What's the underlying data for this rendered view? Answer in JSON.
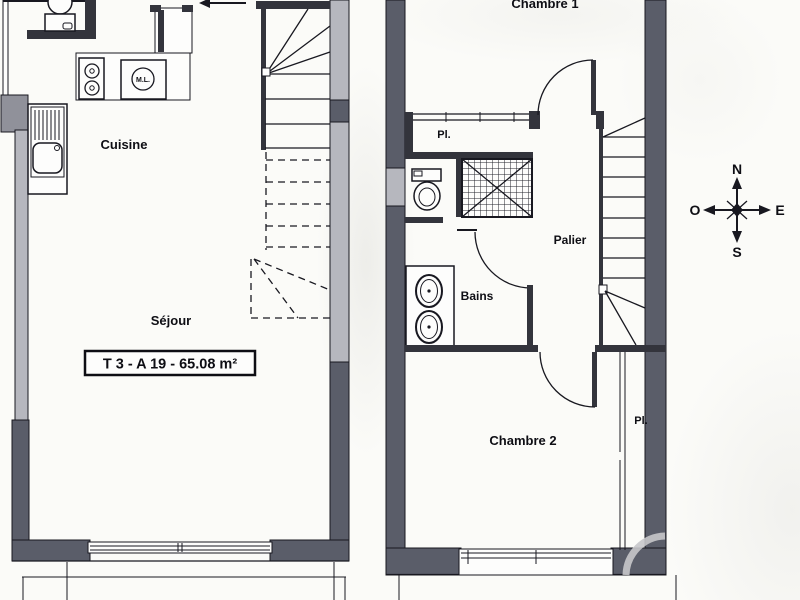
{
  "colors": {
    "wall_dark": "#5a5d69",
    "wall_mid": "#90919a",
    "wall_window": "#b6b7be",
    "line": "#181820",
    "paper": "#fbfbf8",
    "ghost_arc": "#c6c6ca"
  },
  "ground_floor": {
    "cuisine_label": "Cuisine",
    "sejour_label": "Séjour",
    "area_label": "T 3 - A 19 - 65.08 m²",
    "washer_label": "M.L."
  },
  "upper_floor": {
    "chambre1_label": "Chambre 1",
    "closet_top_label": "Pl.",
    "palier_label": "Palier",
    "bains_label": "Bains",
    "chambre2_label": "Chambre 2",
    "closet_right_label": "Pl."
  },
  "compass": {
    "north": "N",
    "west": "O",
    "east": "E",
    "south": "S"
  }
}
